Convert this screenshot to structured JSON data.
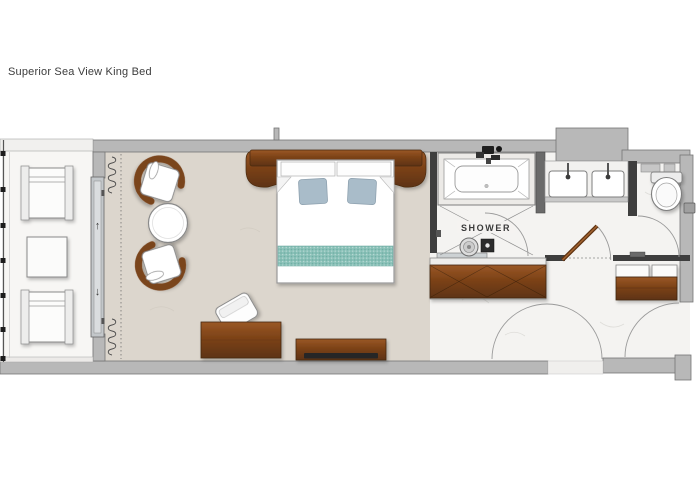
{
  "title": "Superior Sea View King Bed",
  "plan": {
    "labels": {
      "shower": "SHOWER"
    },
    "icons": {
      "slider_up": "↑",
      "slider_down": "↓"
    },
    "colors": {
      "wall": "#b8b8b8",
      "wall_edge": "#757575",
      "wall_dark": "#3e3e3e",
      "wood_light": "#9a5826",
      "wood_mid": "#7c4217",
      "wood_dark": "#5e3312",
      "bedroom_floor": "#dcd6cd",
      "marble_floor": "#f4f3f1",
      "balcony_floor": "#f7f6f4",
      "runner_teal": "#8ac1b8",
      "runner_teal_dark": "#6faea4",
      "pillow_blue": "#a9bcc9",
      "glass": "#cdd2d4"
    },
    "rooms": [
      {
        "name": "balcony"
      },
      {
        "name": "bedroom"
      },
      {
        "name": "bathroom"
      },
      {
        "name": "wc"
      },
      {
        "name": "entry-corridor"
      }
    ],
    "furniture": [
      "lounge chair",
      "lounge chair",
      "balcony side table",
      "sliding glass door",
      "armchair",
      "armchair",
      "round side table",
      "king bed",
      "desk",
      "desk chair",
      "tv console",
      "bathtub",
      "walk-in shower",
      "double vanity",
      "toilet",
      "wardrobe",
      "minibar cabinet"
    ]
  }
}
